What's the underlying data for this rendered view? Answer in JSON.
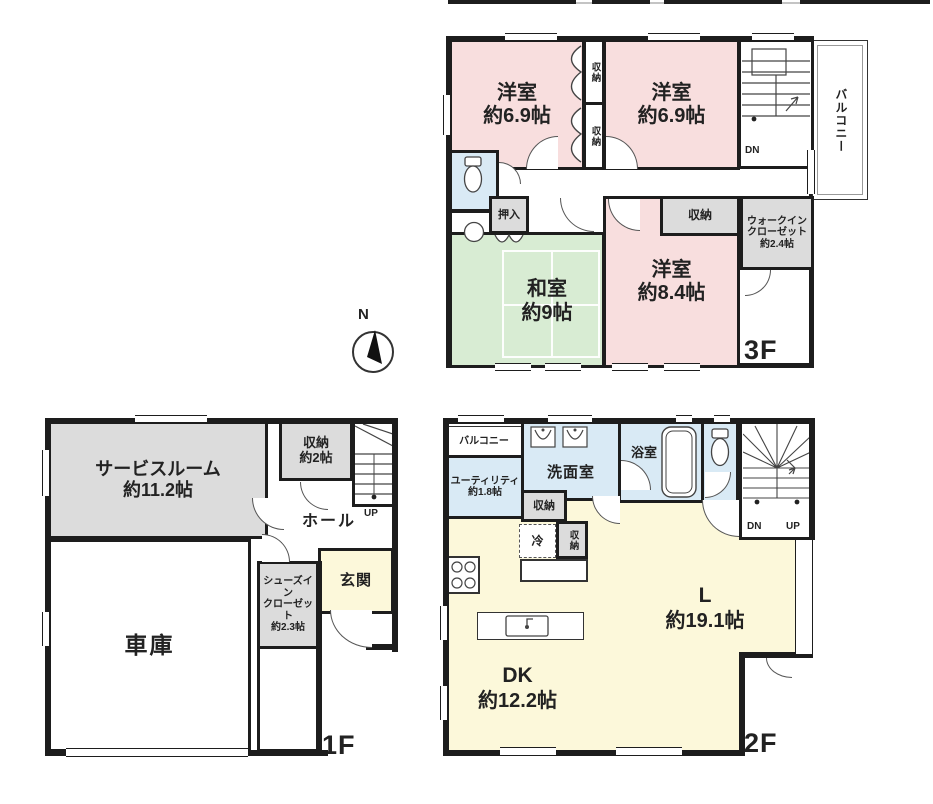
{
  "plan": {
    "compass_label": "N",
    "colors": {
      "wall": "#1d1d1d",
      "bedroom": "#f8dede",
      "tatami": "#d8ecd3",
      "storage": "#dcdcdc",
      "water": "#d9eaf5",
      "living": "#fcf8da"
    },
    "f3": {
      "floor_label": "3F",
      "bedroom_a": {
        "name": "洋室",
        "area": "約6.9帖"
      },
      "bedroom_b": {
        "name": "洋室",
        "area": "約6.9帖"
      },
      "closet_a": "収納",
      "closet_b": "収納",
      "balcony": "バルコニー",
      "stairs_down": "DN",
      "oshiire": "押入",
      "washitsu": {
        "name": "和室",
        "area": "約9帖"
      },
      "bedroom_c": {
        "name": "洋室",
        "area": "約8.4帖"
      },
      "closet_c": "収納",
      "wic": {
        "line1": "ウォークイン",
        "line2": "クローゼット",
        "line3": "約2.4帖"
      }
    },
    "f1": {
      "floor_label": "1F",
      "service_room": {
        "name": "サービスルーム",
        "area": "約11.2帖"
      },
      "closet": {
        "name": "収納",
        "area": "約2帖"
      },
      "stairs_up": "UP",
      "hall": "ホール",
      "genkan": "玄関",
      "sic": {
        "line1": "シューズイン",
        "line2": "クローゼット",
        "line3": "約2.3帖"
      },
      "garage": "車庫"
    },
    "f2": {
      "floor_label": "2F",
      "balcony": "バルコニー",
      "utility": {
        "name": "ユーティリティ",
        "area": "約1.8帖"
      },
      "washroom": "洗面室",
      "bathroom": "浴室",
      "stairs_down": "DN",
      "stairs_up": "UP",
      "closet_a": "収納",
      "fridge": "冷",
      "closet_b": "収納",
      "living": {
        "name": "L",
        "area": "約19.1帖"
      },
      "dk": {
        "name": "DK",
        "area": "約12.2帖"
      }
    }
  }
}
